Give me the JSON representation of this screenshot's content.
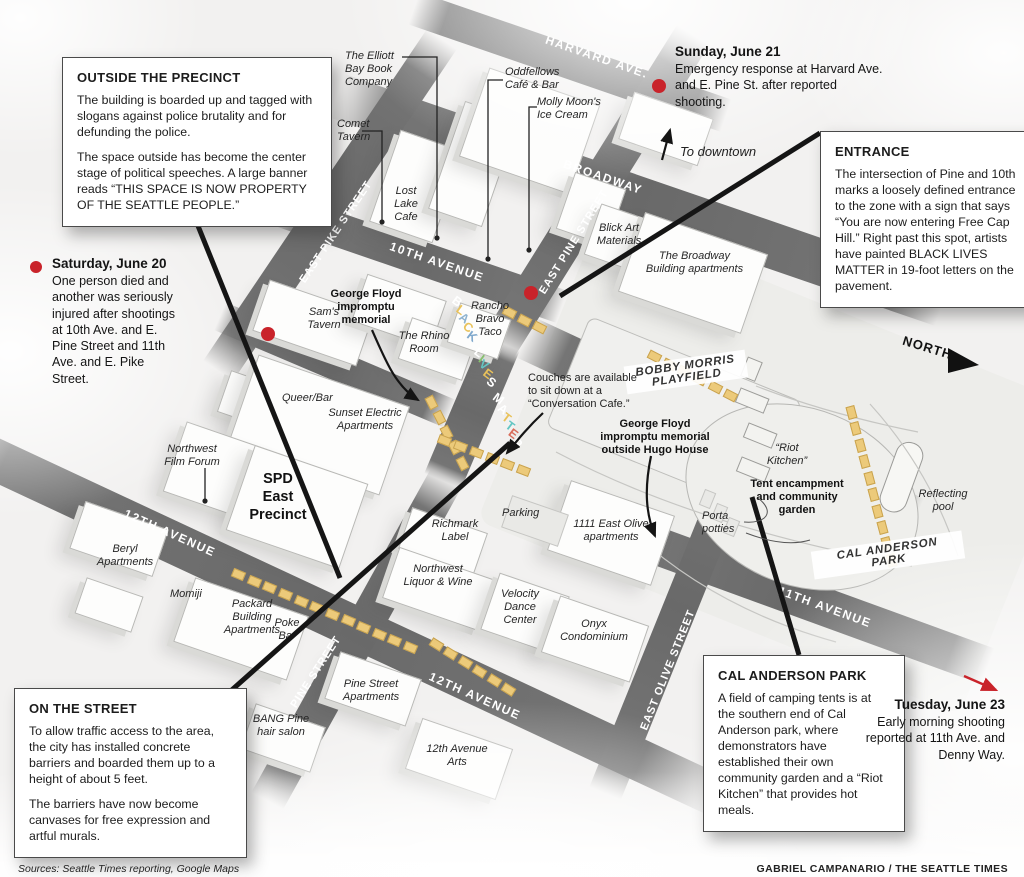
{
  "callouts": {
    "outside_precinct": {
      "title": "OUTSIDE THE PRECINCT",
      "p1": "The building is boarded up and tagged with slogans against police brutality and for defunding the police.",
      "p2": "The space outside has become the center stage of political speeches. A large banner reads “THIS SPACE IS NOW PROPERTY OF THE SEATTLE PEOPLE.”"
    },
    "entrance": {
      "title": "ENTRANCE",
      "p1": "The intersection of Pine and 10th marks a loosely defined entrance to the zone with a sign that says “You are now entering Free Cap Hill.” Right past this spot, artists have painted BLACK LIVES MATTER in 19-foot letters on the pavement."
    },
    "on_the_street": {
      "title": "ON THE STREET",
      "p1": "To allow traffic access to the area, the city has installed concrete barriers and boarded them up to a height of about 5 feet.",
      "p2": "The barriers have now become canvases for free expression and artful murals."
    },
    "cal_anderson": {
      "title": "CAL ANDERSON PARK",
      "p1": "A field of camping tents is at the southern end of Cal Anderson park, where demonstrators have established their own community garden and a “Riot Kitchen” that provides hot meals."
    }
  },
  "events": {
    "sunday": {
      "date": "Sunday, June 21",
      "text": "Emergency response at Harvard Ave. and E. Pine St. after reported shooting."
    },
    "saturday": {
      "date": "Saturday, June 20",
      "text": "One person died and another was seriously injured after shootings at 10th Ave. and E. Pine Street and 11th Ave. and E. Pike Street."
    },
    "tuesday": {
      "date": "Tuesday, June 23",
      "text": "Early morning shooting reported at 11th Ave. and Denny Way."
    }
  },
  "map": {
    "streets": {
      "harvard": "HARVARD AVE.",
      "broadway": "BROADWAY",
      "tenth": "10TH AVENUE",
      "east_pike": "EAST PIKE STREET",
      "east_pine": "EAST PINE STREET",
      "twelfth_upper": "12TH AVENUE",
      "twelfth_lower": "12TH AVENUE",
      "pine": "PINE STREET",
      "east_olive": "EAST OLIVE STREET",
      "eleventh": "11TH AVENUE"
    },
    "blm_mural": {
      "text": "BLACK LIVES MATTER",
      "letter_colors": [
        "#ffffff",
        "#e9c25a",
        "#8fb3cf",
        "#e9c25a",
        "#7fa8cc",
        "#ffffff",
        "#86bf6e",
        "#63c6c3",
        "#e9c25a",
        "#ffffff",
        "#ffffff",
        "#ffffff",
        "#e9c25a",
        "#63c6c3",
        "#d96c5a",
        "#ffffff"
      ]
    },
    "places": {
      "elliott_bay": "The Elliott\nBay Book\nCompany",
      "comet": "Comet\nTavern",
      "lost_lake": "Lost\nLake\nCafe",
      "oddfellows": "Oddfellows\nCafé & Bar",
      "molly_moon": "Molly Moon's\nIce Cream",
      "blick": "Blick Art\nMaterials",
      "broadway_building": "The Broadway\nBuilding apartments",
      "sams_tavern": "Sam's\nTavern",
      "george_floyd_memorial": "George Floyd\nimpromptu\nmemorial",
      "rancho_bravo": "Rancho\nBravo\nTaco",
      "rhino_room": "The Rhino\nRoom",
      "queer_bar": "Queer/Bar",
      "sunset_electric": "Sunset Electric\nApartments",
      "nw_film_forum": "Northwest\nFilm Forum",
      "spd_precinct": "SPD\nEast\nPrecinct",
      "beryl": "Beryl\nApartments",
      "momiji": "Momiji",
      "packard": "Packard\nBuilding\nApartments",
      "poke_bar": "Poke\nBar",
      "pine_street_apts": "Pine Street\nApartments",
      "bang_pine": "BANG Pine\nhair salon",
      "twelfth_ave_arts": "12th Avenue\nArts",
      "richmark": "Richmark\nLabel",
      "nw_liquor": "Northwest\nLiquor & Wine",
      "parking": "Parking",
      "velocity": "Velocity\nDance\nCenter",
      "east_olive_apts": "1111 East Olive\napartments",
      "onyx": "Onyx\nCondominium",
      "porta_potties": "Porta\npotties",
      "riot_kitchen": "“Riot\nKitchen”",
      "tent_encampment": "Tent encampment\nand community\ngarden",
      "couches": "Couches are available\nto sit down at a\n“Conversation Cafe.”",
      "hugo_house": "George Floyd\nimpromptu memorial\noutside Hugo House",
      "reflecting_pool": "Reflecting\npool"
    },
    "park_labels": {
      "bobby_morris": "BOBBY MORRIS\nPLAYFIELD",
      "cal_anderson": "CAL ANDERSON PARK"
    },
    "compass": {
      "north": "NORTH",
      "to_downtown": "To downtown"
    }
  },
  "colors": {
    "street": "#6d6d6d",
    "red_marker": "#c9232a",
    "barrier_yellow": "#ecca7a",
    "leader_black": "#151515"
  },
  "footer": {
    "sources": "Sources: Seattle Times reporting, Google Maps",
    "credit": "GABRIEL CAMPANARIO / THE SEATTLE TIMES"
  }
}
